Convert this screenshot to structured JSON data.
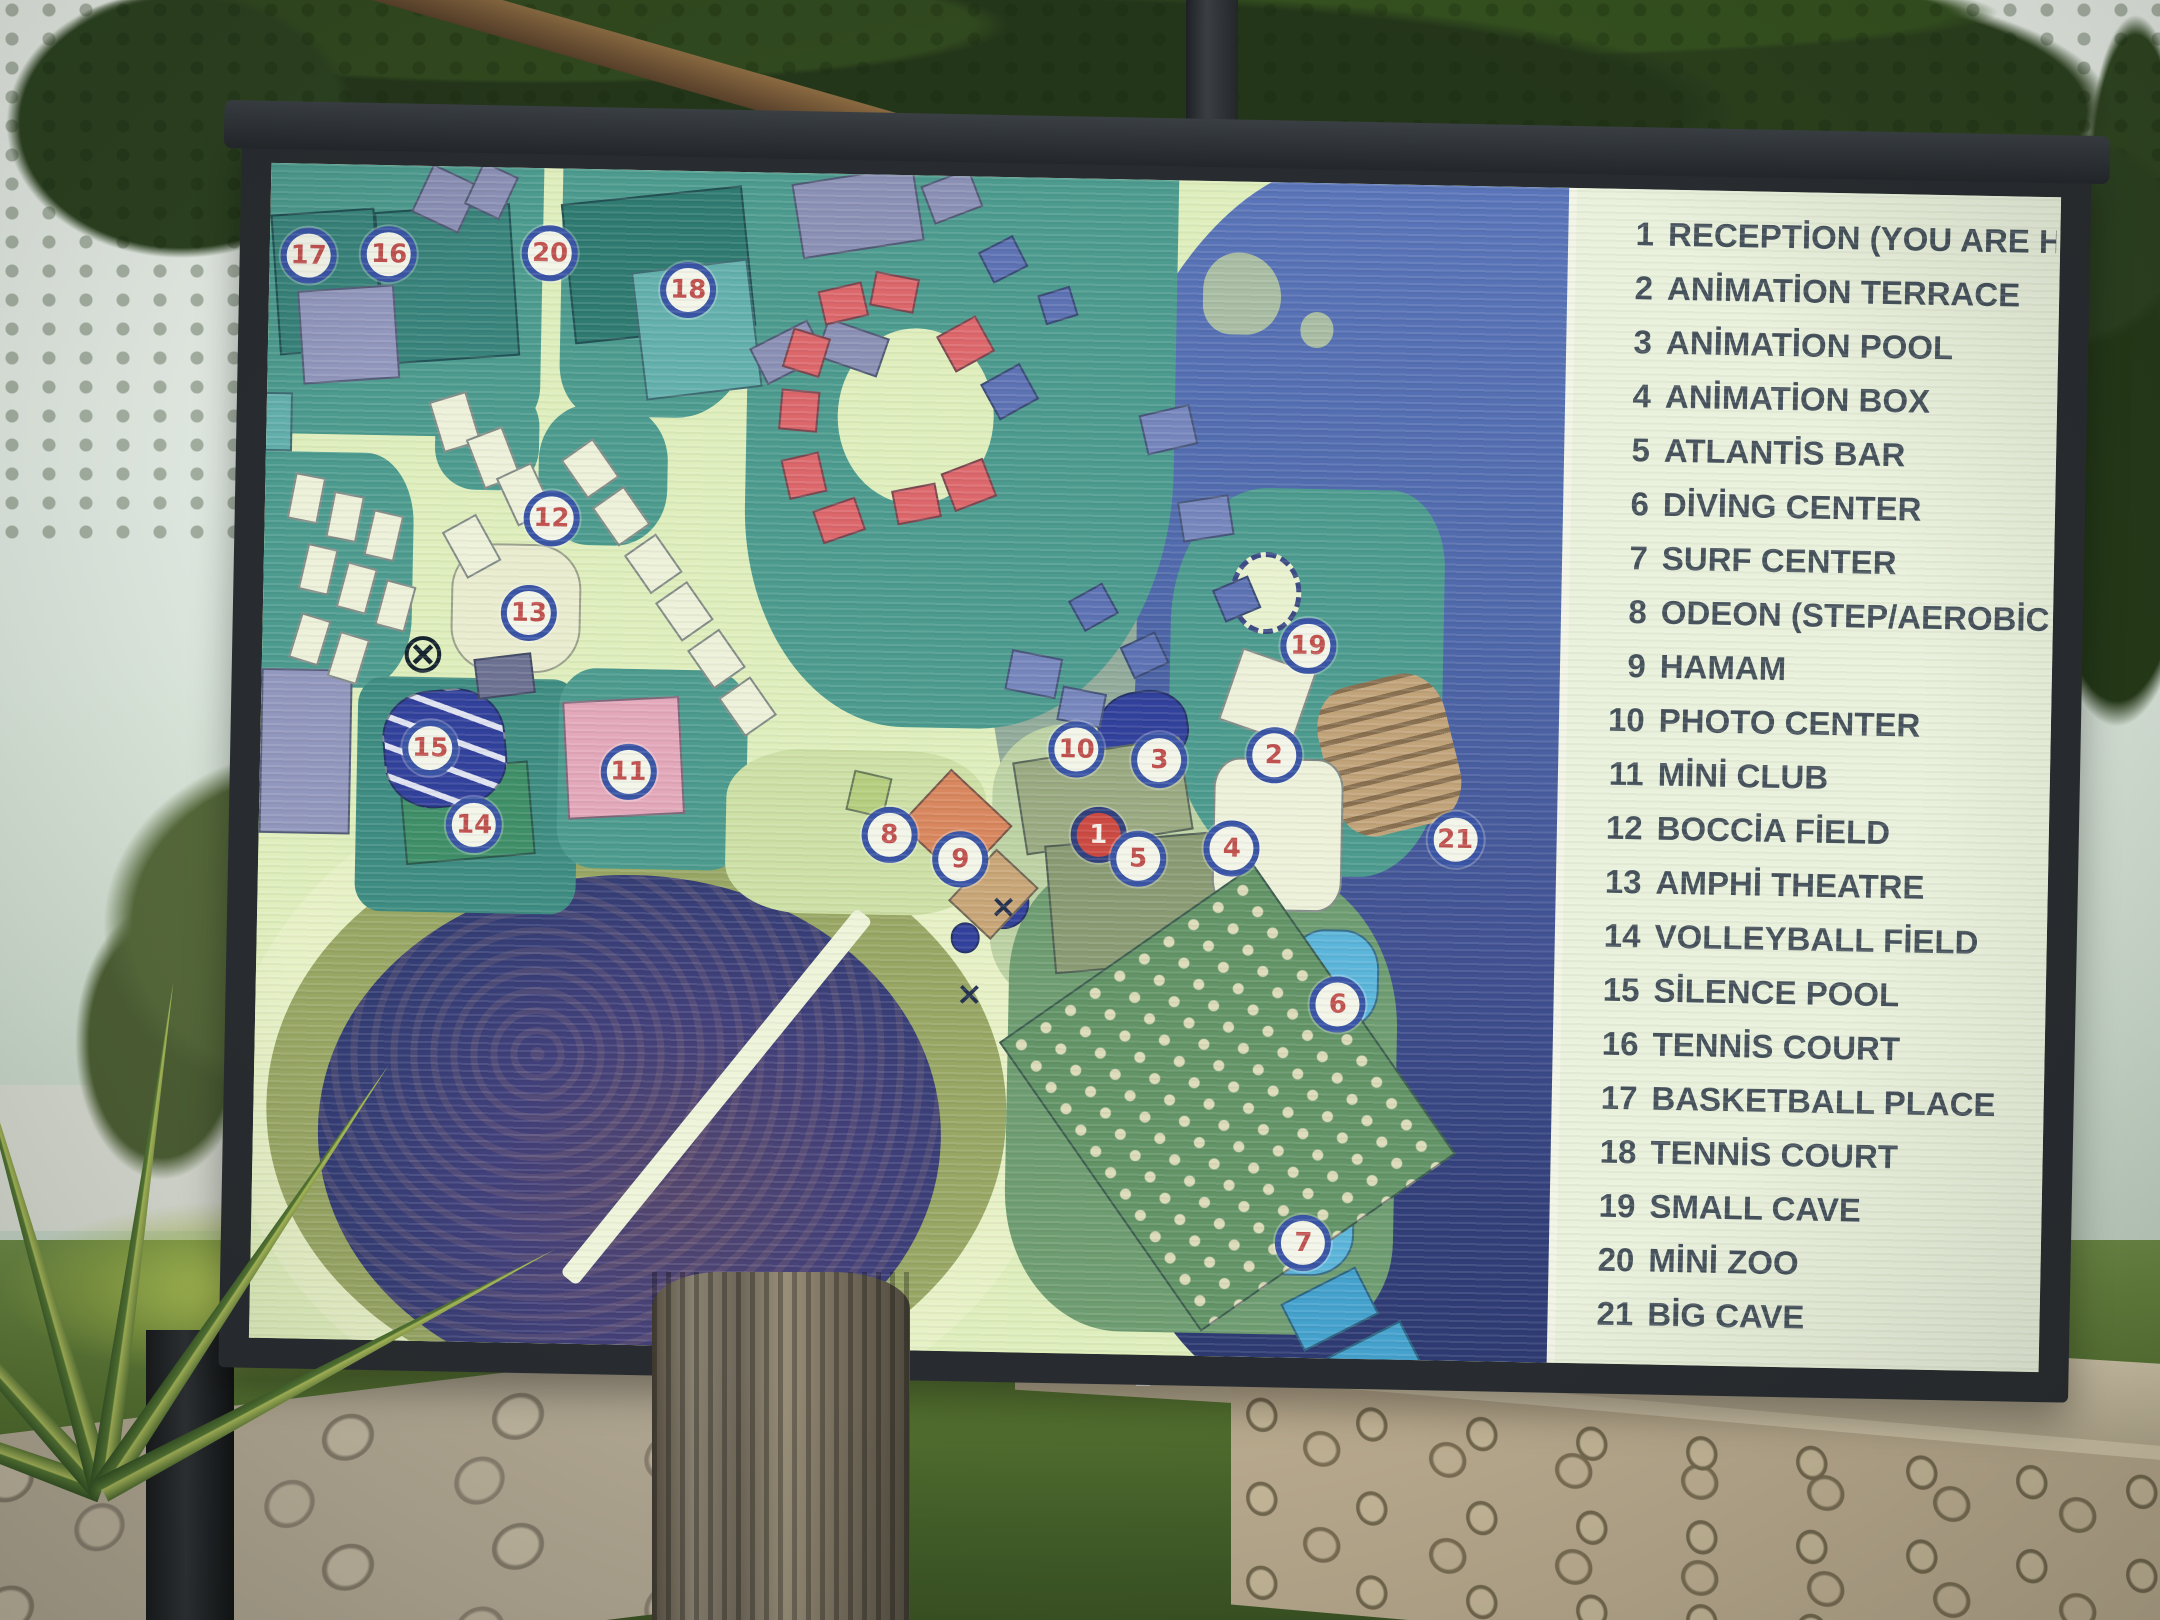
{
  "legend": {
    "items": [
      {
        "number": "1",
        "label": "RECEPTİON (YOU ARE HERE)"
      },
      {
        "number": "2",
        "label": "ANİMATİON TERRACE"
      },
      {
        "number": "3",
        "label": "ANİMATİON POOL"
      },
      {
        "number": "4",
        "label": "ANİMATİON BOX"
      },
      {
        "number": "5",
        "label": "ATLANTİS BAR"
      },
      {
        "number": "6",
        "label": "DİVİNG CENTER"
      },
      {
        "number": "7",
        "label": "SURF CENTER"
      },
      {
        "number": "8",
        "label": "ODEON (STEP/AEROBİC PLACE)"
      },
      {
        "number": "9",
        "label": "HAMAM"
      },
      {
        "number": "10",
        "label": "PHOTO CENTER"
      },
      {
        "number": "11",
        "label": "MİNİ CLUB"
      },
      {
        "number": "12",
        "label": "BOCCİA FİELD"
      },
      {
        "number": "13",
        "label": "AMPHİ THEATRE"
      },
      {
        "number": "14",
        "label": "VOLLEYBALL FİELD"
      },
      {
        "number": "15",
        "label": "SİLENCE POOL"
      },
      {
        "number": "16",
        "label": "TENNİS COURT"
      },
      {
        "number": "17",
        "label": "BASKETBALL PLACE"
      },
      {
        "number": "18",
        "label": "TENNİS COURT"
      },
      {
        "number": "19",
        "label": "SMALL CAVE"
      },
      {
        "number": "20",
        "label": "MİNİ ZOO"
      },
      {
        "number": "21",
        "label": "BİG CAVE"
      }
    ]
  },
  "map": {
    "markers": [
      {
        "n": "1",
        "x": 64.7,
        "y": 55.8,
        "variant": "you-are-here"
      },
      {
        "n": "2",
        "x": 78.1,
        "y": 48.8,
        "variant": "default"
      },
      {
        "n": "3",
        "x": 69.3,
        "y": 49.4,
        "variant": "default"
      },
      {
        "n": "4",
        "x": 75.0,
        "y": 56.8,
        "variant": "default"
      },
      {
        "n": "5",
        "x": 67.8,
        "y": 57.8,
        "variant": "default"
      },
      {
        "n": "6",
        "x": 83.4,
        "y": 69.9,
        "variant": "default"
      },
      {
        "n": "7",
        "x": 81.1,
        "y": 90.2,
        "variant": "default"
      },
      {
        "n": "8",
        "x": 48.6,
        "y": 56.2,
        "variant": "default"
      },
      {
        "n": "9",
        "x": 54.1,
        "y": 58.1,
        "variant": "default"
      },
      {
        "n": "10",
        "x": 62.9,
        "y": 48.6,
        "variant": "default"
      },
      {
        "n": "11",
        "x": 28.4,
        "y": 51.2,
        "variant": "default"
      },
      {
        "n": "12",
        "x": 22.1,
        "y": 29.8,
        "variant": "default"
      },
      {
        "n": "13",
        "x": 20.5,
        "y": 37.9,
        "variant": "default"
      },
      {
        "n": "14",
        "x": 16.6,
        "y": 56.0,
        "variant": "default"
      },
      {
        "n": "15",
        "x": 13.1,
        "y": 49.5,
        "variant": "default"
      },
      {
        "n": "16",
        "x": 9.2,
        "y": 7.6,
        "variant": "default"
      },
      {
        "n": "17",
        "x": 3.0,
        "y": 7.8,
        "variant": "default"
      },
      {
        "n": "18",
        "x": 32.3,
        "y": 10.1,
        "variant": "default"
      },
      {
        "n": "19",
        "x": 80.6,
        "y": 39.4,
        "variant": "default"
      },
      {
        "n": "20",
        "x": 21.6,
        "y": 7.2,
        "variant": "default"
      },
      {
        "n": "21",
        "x": 92.2,
        "y": 55.7,
        "variant": "default"
      }
    ],
    "symbols": [
      {
        "name": "crossed-circle",
        "x": 12.4,
        "y": 41.5,
        "glyph": "⊗"
      },
      {
        "name": "x-mark",
        "x": 57.5,
        "y": 62.0,
        "glyph": "×"
      },
      {
        "name": "x-mark",
        "x": 55.0,
        "y": 69.5,
        "glyph": "×"
      }
    ],
    "buildings": [
      {
        "x": 0.5,
        "y": 4,
        "w": 8,
        "h": 12,
        "r": -5,
        "c": "court"
      },
      {
        "x": 8.5,
        "y": 3.5,
        "w": 10.5,
        "h": 13,
        "r": -5,
        "c": "court"
      },
      {
        "x": 23,
        "y": 2,
        "w": 14,
        "h": 12,
        "r": -7,
        "c": "courtdark"
      },
      {
        "x": 28.5,
        "y": 8,
        "w": 9,
        "h": 11,
        "r": -8,
        "c": "court2"
      },
      {
        "x": -1,
        "y": 19.5,
        "w": 3,
        "h": 5,
        "r": 0,
        "c": "court2"
      },
      {
        "x": 11,
        "y": 51,
        "w": 10,
        "h": 8,
        "r": -6,
        "c": "courtgreen"
      },
      {
        "x": 14.5,
        "y": 32,
        "w": 10,
        "h": 11,
        "r": 0,
        "c": "cream",
        "br": 35
      },
      {
        "x": 23.5,
        "y": 45,
        "w": 9,
        "h": 10,
        "r": -4,
        "c": "pink"
      },
      {
        "x": 9.5,
        "y": 44.5,
        "w": 9.5,
        "h": 10,
        "r": -6,
        "c": "navy striped",
        "br": 40
      },
      {
        "x": 64.5,
        "y": 43.5,
        "w": 7,
        "h": 6.5,
        "r": -10,
        "c": "navy",
        "br": 45
      },
      {
        "x": 55.5,
        "y": 59.5,
        "w": 4,
        "h": 4.5,
        "r": 0,
        "c": "navy",
        "br": 50
      },
      {
        "x": 53.5,
        "y": 63.5,
        "w": 2.2,
        "h": 2.6,
        "r": 0,
        "c": "navy",
        "br": 50
      },
      {
        "x": 79.5,
        "y": 63.5,
        "w": 7,
        "h": 8.5,
        "r": 0,
        "c": "cyan",
        "br": 40
      },
      {
        "x": 75.5,
        "y": 83,
        "w": 9.5,
        "h": 10,
        "r": 0,
        "c": "cyan",
        "br": 35
      },
      {
        "x": 80,
        "y": 93.5,
        "w": 6.5,
        "h": 4.5,
        "r": -28,
        "c": "cyan2"
      },
      {
        "x": 83.5,
        "y": 98,
        "w": 6.5,
        "h": 4.5,
        "r": -28,
        "c": "cyan2"
      },
      {
        "x": 50.5,
        "y": 52,
        "w": 6.5,
        "h": 6.5,
        "r": 42,
        "c": "orange"
      },
      {
        "x": 54.5,
        "y": 58,
        "w": 4.5,
        "h": 6,
        "r": 42,
        "c": "tan"
      },
      {
        "x": 45.5,
        "y": 51,
        "w": 3,
        "h": 3.5,
        "r": 12,
        "c": "lime"
      },
      {
        "x": 58.5,
        "y": 48.5,
        "w": 13,
        "h": 8,
        "r": -10,
        "c": "olive"
      },
      {
        "x": 61,
        "y": 56,
        "w": 14,
        "h": 11,
        "r": -6,
        "c": "olivedark"
      },
      {
        "x": 73.5,
        "y": 49,
        "w": 10,
        "h": 13,
        "r": 0,
        "c": "white",
        "br": 20
      },
      {
        "x": 74.5,
        "y": 40.5,
        "w": 6,
        "h": 6.5,
        "r": 18,
        "c": "white"
      },
      {
        "x": 2.5,
        "y": 10.5,
        "w": 7.5,
        "h": 8,
        "r": -5,
        "c": "purple"
      },
      {
        "x": 0,
        "y": 43,
        "w": 7,
        "h": 14,
        "r": 0,
        "c": "purple"
      },
      {
        "x": 11.5,
        "y": 0.5,
        "w": 4,
        "h": 4.5,
        "r": 24,
        "c": "slate"
      },
      {
        "x": 15.5,
        "y": 0,
        "w": 3,
        "h": 4,
        "r": 24,
        "c": "slate"
      },
      {
        "x": 40.5,
        "y": 0,
        "w": 9.5,
        "h": 6.5,
        "r": -10,
        "c": "slate"
      },
      {
        "x": 50.5,
        "y": 0,
        "w": 4,
        "h": 3.5,
        "r": -22,
        "c": "slate"
      },
      {
        "x": 37.5,
        "y": 13.5,
        "w": 5,
        "h": 3.5,
        "r": -28,
        "c": "slate"
      },
      {
        "x": 42.5,
        "y": 13,
        "w": 5,
        "h": 3.5,
        "r": 18,
        "c": "slate"
      },
      {
        "x": 16.5,
        "y": 41.5,
        "w": 4.5,
        "h": 3.5,
        "r": -8,
        "c": "slatedark"
      },
      {
        "x": 2,
        "y": 26.5,
        "w": 2.4,
        "h": 4,
        "r": 10,
        "c": "white"
      },
      {
        "x": 5,
        "y": 28,
        "w": 2.4,
        "h": 4,
        "r": 10,
        "c": "white"
      },
      {
        "x": 8,
        "y": 29.5,
        "w": 2.4,
        "h": 4,
        "r": 12,
        "c": "white"
      },
      {
        "x": 3,
        "y": 32.5,
        "w": 2.4,
        "h": 4,
        "r": 12,
        "c": "white"
      },
      {
        "x": 6,
        "y": 34,
        "w": 2.4,
        "h": 4,
        "r": 14,
        "c": "white"
      },
      {
        "x": 9,
        "y": 35.5,
        "w": 2.4,
        "h": 4,
        "r": 14,
        "c": "white"
      },
      {
        "x": 2.5,
        "y": 38.5,
        "w": 2.4,
        "h": 4,
        "r": 16,
        "c": "white"
      },
      {
        "x": 5.5,
        "y": 40,
        "w": 2.4,
        "h": 4,
        "r": 16,
        "c": "white"
      },
      {
        "x": 13,
        "y": 19.5,
        "w": 3,
        "h": 4.5,
        "r": -18,
        "c": "white"
      },
      {
        "x": 16,
        "y": 22.5,
        "w": 3,
        "h": 4.5,
        "r": -22,
        "c": "white"
      },
      {
        "x": 18.5,
        "y": 25.5,
        "w": 3,
        "h": 4.5,
        "r": -26,
        "c": "white"
      },
      {
        "x": 14.5,
        "y": 30,
        "w": 3,
        "h": 4.5,
        "r": -30,
        "c": "white"
      },
      {
        "x": 23.5,
        "y": 23.5,
        "w": 3,
        "h": 4,
        "r": -36,
        "c": "white"
      },
      {
        "x": 26,
        "y": 27.5,
        "w": 3,
        "h": 4,
        "r": -36,
        "c": "white"
      },
      {
        "x": 28.5,
        "y": 31.5,
        "w": 3,
        "h": 4,
        "r": -36,
        "c": "white"
      },
      {
        "x": 31,
        "y": 35.5,
        "w": 3,
        "h": 4,
        "r": -36,
        "c": "white"
      },
      {
        "x": 33.5,
        "y": 39.5,
        "w": 3,
        "h": 4,
        "r": -36,
        "c": "white"
      },
      {
        "x": 36,
        "y": 43.5,
        "w": 3,
        "h": 4,
        "r": -36,
        "c": "white"
      },
      {
        "x": 42.5,
        "y": 9.5,
        "w": 3.5,
        "h": 3,
        "r": -14,
        "c": "red"
      },
      {
        "x": 46.5,
        "y": 8.5,
        "w": 3.5,
        "h": 3,
        "r": 10,
        "c": "red"
      },
      {
        "x": 40,
        "y": 13.5,
        "w": 3,
        "h": 3.5,
        "r": 16,
        "c": "red"
      },
      {
        "x": 39.5,
        "y": 18.5,
        "w": 3,
        "h": 3.5,
        "r": 4,
        "c": "red"
      },
      {
        "x": 40,
        "y": 24,
        "w": 3,
        "h": 3.5,
        "r": -14,
        "c": "red"
      },
      {
        "x": 42.5,
        "y": 28,
        "w": 3.5,
        "h": 3,
        "r": -20,
        "c": "red"
      },
      {
        "x": 48.5,
        "y": 26.5,
        "w": 3.5,
        "h": 3,
        "r": -12,
        "c": "red"
      },
      {
        "x": 52.5,
        "y": 24.5,
        "w": 3.5,
        "h": 3.5,
        "r": -22,
        "c": "red"
      },
      {
        "x": 52,
        "y": 12.5,
        "w": 3.5,
        "h": 3.5,
        "r": -30,
        "c": "red"
      },
      {
        "x": 55.5,
        "y": 16.5,
        "w": 3.5,
        "h": 3.5,
        "r": -30,
        "c": "blue"
      },
      {
        "x": 55,
        "y": 5.5,
        "w": 3,
        "h": 3,
        "r": -28,
        "c": "blue"
      },
      {
        "x": 59.5,
        "y": 9.5,
        "w": 2.6,
        "h": 2.6,
        "r": -18,
        "c": "blue"
      },
      {
        "x": 67.5,
        "y": 19.5,
        "w": 4,
        "h": 3.5,
        "r": -14,
        "c": "blue2"
      },
      {
        "x": 70.5,
        "y": 27,
        "w": 4,
        "h": 3.5,
        "r": -10,
        "c": "blue2"
      },
      {
        "x": 73.5,
        "y": 34,
        "w": 3,
        "h": 3,
        "r": -24,
        "c": "blue"
      },
      {
        "x": 62.5,
        "y": 35,
        "w": 3,
        "h": 3,
        "r": -30,
        "c": "blue"
      },
      {
        "x": 66.5,
        "y": 39,
        "w": 3,
        "h": 3,
        "r": -26,
        "c": "blue"
      },
      {
        "x": 57.5,
        "y": 40.5,
        "w": 4,
        "h": 3.5,
        "r": 10,
        "c": "blue2"
      },
      {
        "x": 61.5,
        "y": 43.5,
        "w": 3.5,
        "h": 3,
        "r": 10,
        "c": "blue2"
      },
      {
        "x": 63,
        "y": 63,
        "w": 24,
        "h": 30,
        "r": -36,
        "c": "beach"
      }
    ]
  },
  "colors": {
    "sea": "#5571b4",
    "sea_deep": "#2e3a70",
    "land": "#4d9b8f",
    "path": "#dfeebc",
    "legend_bg": "#e9f0db",
    "legend_text": "#46525c",
    "frame": "#282c30",
    "marker_ring": "#3a55a5",
    "marker_number": "#c05250",
    "you_are_here_fill": "#cb4a42"
  }
}
